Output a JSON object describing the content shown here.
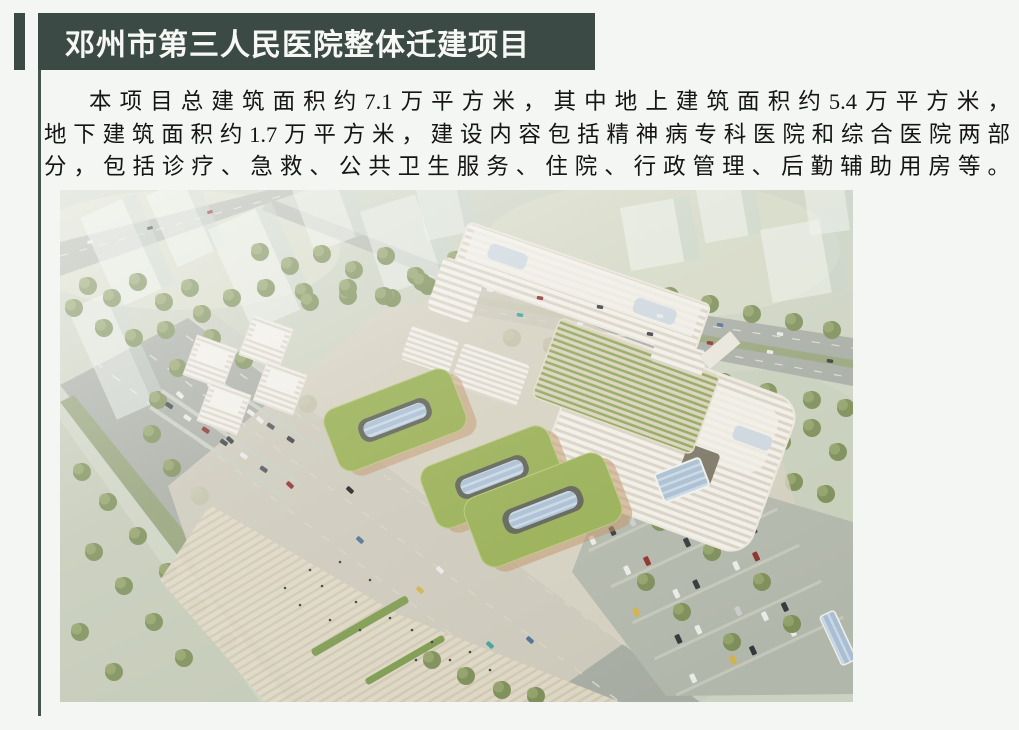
{
  "page": {
    "background": "#f4f6f3",
    "accent_color": "#3b4a44"
  },
  "header": {
    "title": "邓州市第三人民医院整体迁建项目",
    "text_color": "#f7f8f6"
  },
  "body": {
    "paragraph": "本项目总建筑面积约7.1万平方米，其中地上建筑面积约5.4万平方米，地下建筑面积约1.7万平方米，建设内容包括精神病专科医院和综合医院两部分，包括诊疗、急救、公共卫生服务、住院、行政管理、后勤辅助用房等。",
    "lines": [
      "本项目总建筑面积约7.1万平方米，其中地上建筑面积约5.4万平方米，",
      "地下建筑面积约1.7万平方米，建设内容包括精神病专科医院和综合医院两部",
      "分，包括诊疗、急救、公共卫生服务、住院、行政管理、后勤辅助用房等。"
    ]
  },
  "image": {
    "description": "医院整体迁建项目鸟瞰效果图（白色医院建筑群、绿色屋顶、道路与停车场）",
    "palette": {
      "ground": "#ccd2c1",
      "road": "#a7aca3",
      "green_roof": "#97ae52",
      "building": "#f0ede6",
      "tree": "#7d8e58"
    }
  }
}
